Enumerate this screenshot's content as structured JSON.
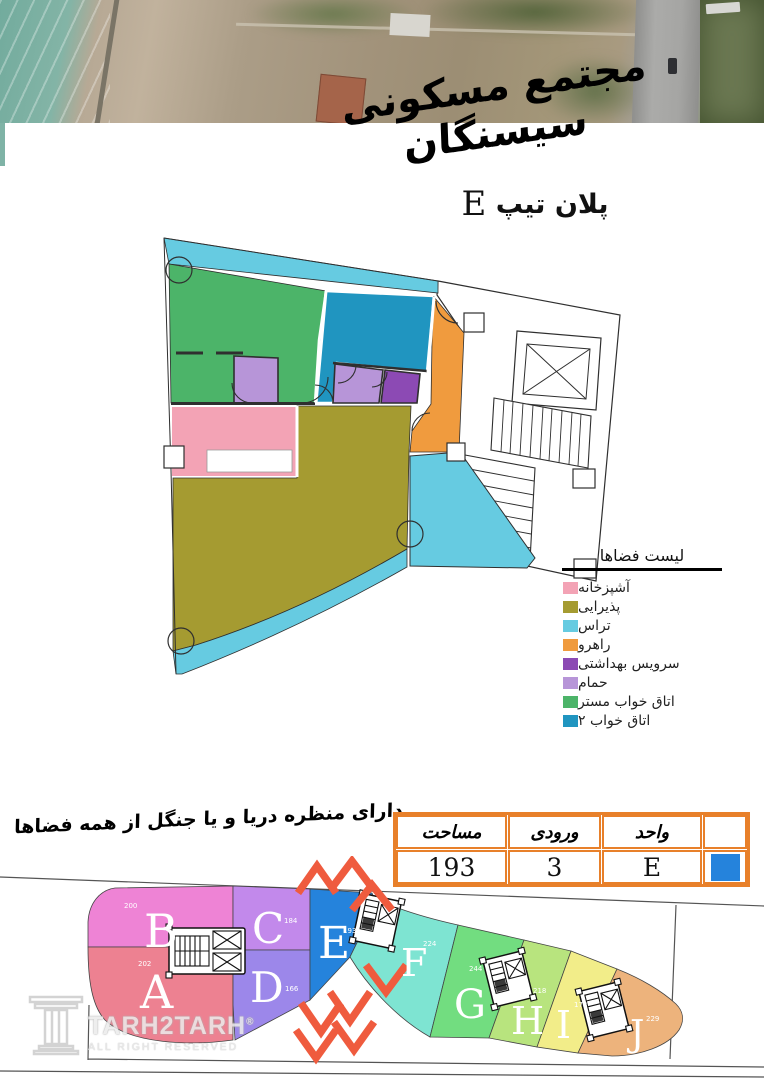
{
  "header": {
    "project_title": "مجتمع مسکونی سیسنگان",
    "plan_label": "پلان تیپ",
    "plan_type": "E"
  },
  "legend": {
    "title": "لیست فضاها",
    "items": [
      {
        "label": "آشپزخانه",
        "color": "#F3A3B5"
      },
      {
        "label": "پذیرایی",
        "color": "#A59B31"
      },
      {
        "label": "تراس",
        "color": "#66CBE1"
      },
      {
        "label": "راهرو",
        "color": "#F09B3E"
      },
      {
        "label": "سرویس بهداشتی",
        "color": "#8C4AB4"
      },
      {
        "label": "حمام",
        "color": "#B795D8"
      },
      {
        "label": "اتاق خواب مستر",
        "color": "#4CB469"
      },
      {
        "label": "اتاق خواب ۲",
        "color": "#2095C0"
      }
    ]
  },
  "slogan": "دارای منظره دریا و یا جنگل از همه فضاها",
  "spec_table": {
    "border_color": "#E8802A",
    "columns": {
      "area": "مساحت",
      "entrance": "ورودی",
      "unit": "واحد"
    },
    "values": {
      "area": "193",
      "entrance": "3",
      "unit": "E"
    },
    "highlight_color": "#2583DC"
  },
  "site_plan": {
    "arrow_color": "#EF5B3E",
    "highlighted_unit": "E",
    "units": [
      {
        "id": "A",
        "area": "202",
        "color": "#ED8191"
      },
      {
        "id": "B",
        "area": "200",
        "color": "#EE83D5"
      },
      {
        "id": "C",
        "area": "184",
        "color": "#C289EB"
      },
      {
        "id": "D",
        "area": "166",
        "color": "#9C87EA"
      },
      {
        "id": "E",
        "area": "193",
        "color": "#2583DC"
      },
      {
        "id": "F",
        "area": "224",
        "color": "#7EE4D2"
      },
      {
        "id": "G",
        "area": "244",
        "color": "#72DD80"
      },
      {
        "id": "H",
        "area": "218",
        "color": "#B8E47E"
      },
      {
        "id": "I",
        "area": "173",
        "color": "#F2ED89"
      },
      {
        "id": "J",
        "area": "229",
        "color": "#EDB37C"
      }
    ]
  },
  "watermark": {
    "brand": "TARH2TARH",
    "registered": "®",
    "rights": "ALL RIGHT RESERVED"
  }
}
